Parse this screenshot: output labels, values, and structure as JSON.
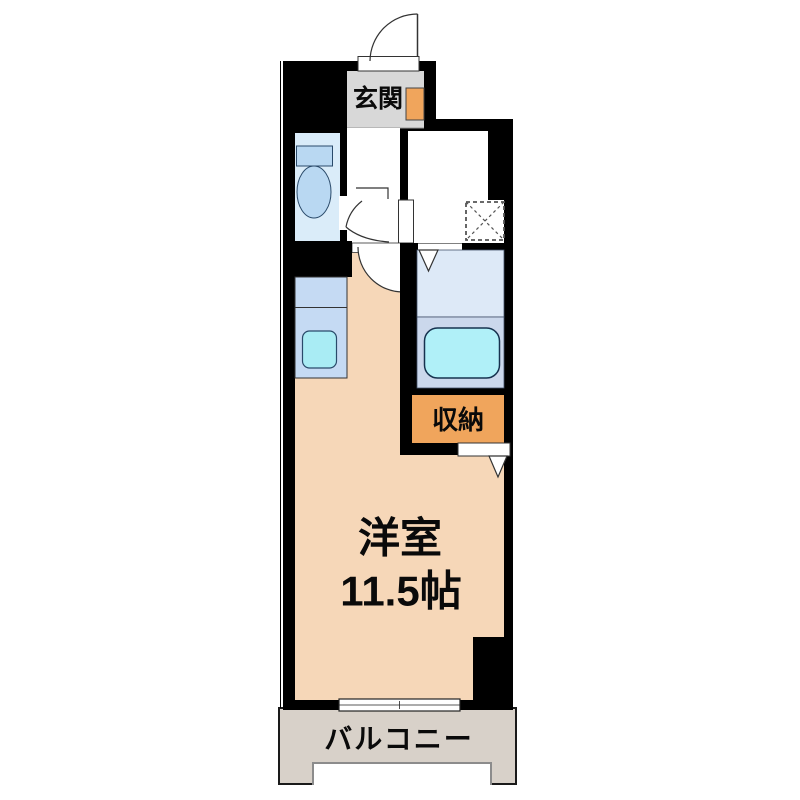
{
  "floorplan": {
    "labels": {
      "entrance": "玄関",
      "storage": "収納",
      "room_type": "洋室",
      "room_size": "11.5帖",
      "balcony": "バルコニー"
    },
    "colors": {
      "wall": "#000000",
      "entrance_floor": "#d8d8d8",
      "accent_orange": "#f0a55c",
      "toilet_floor": "#daecf9",
      "fixture_blue": "#b9d8f2",
      "kitchen_counter": "#c5daf3",
      "sink": "#a9ecf4",
      "bath_floor_upper": "#dde9f7",
      "bath_floor_lower": "#cbd8ec",
      "bathtub": "#b0f0f8",
      "room_floor": "#f6d7b8",
      "balcony_floor": "#d8d1c9"
    }
  }
}
